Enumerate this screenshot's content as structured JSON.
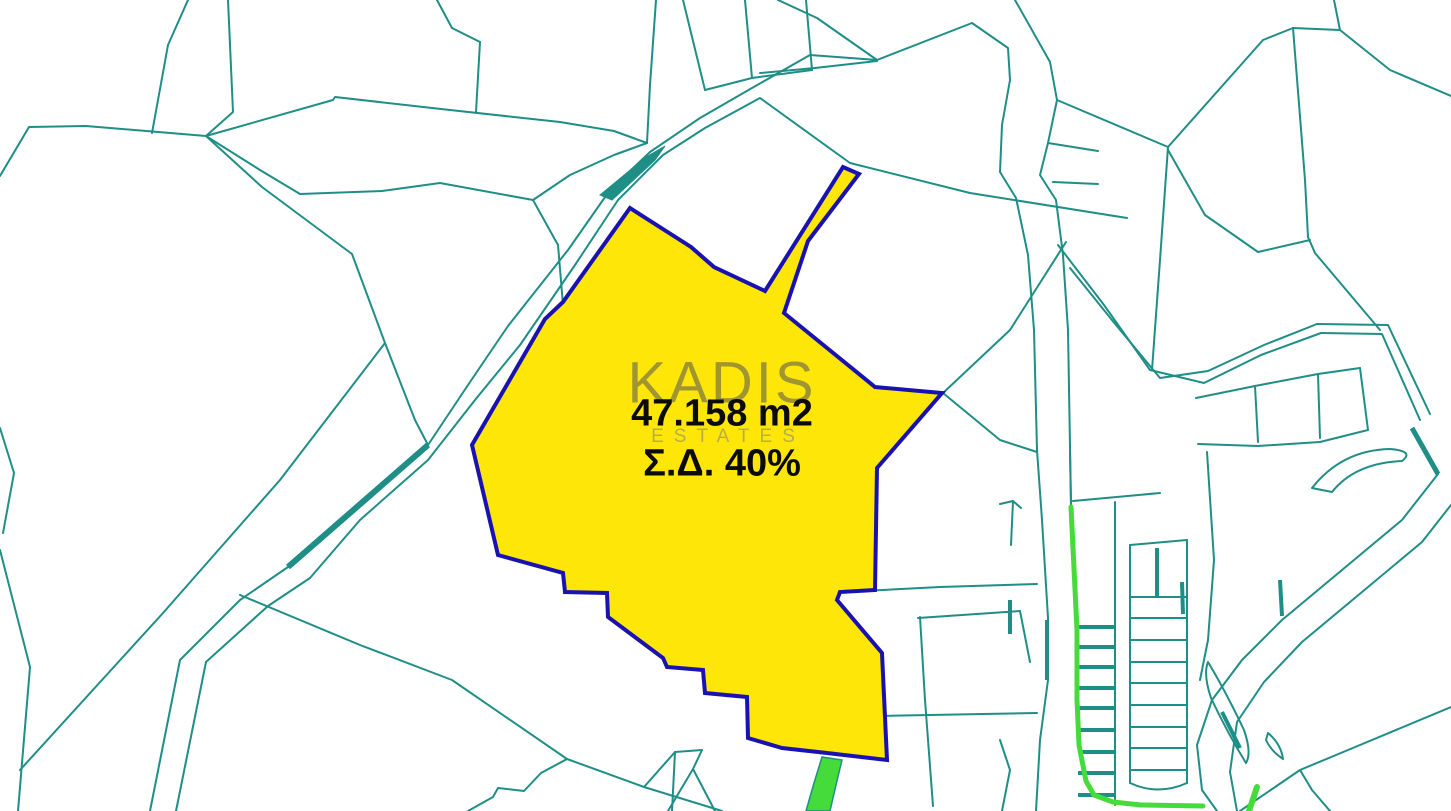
{
  "watermark": {
    "brand": "KADIS",
    "sub": "ESTATES"
  },
  "parcel": {
    "area_label": "47.158 m2",
    "density_label": "Σ.Δ. 40%",
    "points": "630,208 691,247 714,267 765,291 843,167 859,174 808,241 784,313 875,387 942,393 877,468 875,590 840,592 837,600 882,653 887,760 827,753 782,748 748,738 747,697 705,693 703,670 667,667 663,658 608,617 607,593 565,592 563,573 498,555 472,445 545,319 563,302"
  },
  "colors": {
    "line": "#1F8E86",
    "parcel_fill": "#FFE609",
    "parcel_stroke": "#1A12B0",
    "green": "#45DB3B",
    "text": "#0B0B0B",
    "watermark": "#525252"
  },
  "map": {
    "viewbox": "0 0 1451 811",
    "thin_lines": [
      "188,0 168,45 152,133",
      "228,0 233,112 206,136",
      "0,176 29,127 86,126 206,136",
      "206,136 333,100 335,97 450,110 560,122 614,131 647,143",
      "206,136 262,187 352,254 385,343 415,420 428,445",
      "206,136 260,170 300,194 382,191 440,183 533,200",
      "533,200 558,245 563,305",
      "533,200 570,175 614,155 647,143",
      "0,428 14,473 3,533",
      "0,550 30,667 18,811",
      "20,770 163,613 280,480 385,343",
      "150,811 180,660 240,600 288,567",
      "176,811 206,662 268,606 310,578 360,520 428,460 475,400 520,345 575,265 618,200 663,155 705,128 760,98 850,163",
      "428,445 470,382 508,326 568,250 610,190 650,152",
      "650,152 700,118 752,88 810,55 877,60 972,23",
      "778,0 817,18 877,60",
      "760,73 815,68 877,61",
      "850,163 970,193 1127,218",
      "972,23 1008,48 1010,80 1002,125 1000,172 1016,198 1028,255 1034,330 1037,450",
      "1015,0 1050,62 1057,100 1048,143 1040,175 1056,200 1063,255 1068,330 1071,505",
      "1057,100 1168,147 1263,40",
      "1263,40 1293,28",
      "1293,28 1340,30 1334,0",
      "1340,30 1390,70 1451,96",
      "1293,28 1305,180 1308,237",
      "1308,237 1315,253 1380,330",
      "1168,147 1160,260 1152,370",
      "1168,150 1205,215 1258,252",
      "1258,252 1310,240",
      "1058,245 1104,305 1150,370 1204,383 1261,355 1321,333",
      "1070,268 1116,325 1160,378 1208,371 1264,345 1317,324",
      "1321,333 1382,334 1420,420",
      "1317,324 1388,325 1430,414",
      "1438,474 1402,520 1342,570 1282,620 1242,660 1212,700 1197,745 1202,790 1217,811",
      "1451,505 1422,542 1362,592 1302,642 1264,682 1237,722 1230,772 1237,811",
      "1196,398 1255,386 1318,374 1360,368",
      "1255,386 1258,442",
      "1318,374 1320,438",
      "1198,444 1258,446 1320,442",
      "1360,368 1368,430 1320,442",
      "1037,450 1042,520 1048,618 1048,680 1040,740 1036,811",
      "1000,504 1013,501 1021,508",
      "1013,501 1011,545",
      "1071,505 1070,452",
      "1073,501 1160,493",
      "1115,502 1115,805",
      "1130,545 1130,783",
      "1187,540 1187,783",
      "1130,545 1187,540",
      "1130,597 1187,597",
      "1130,618 1187,618",
      "1130,640 1187,640",
      "1130,662 1187,662",
      "1130,683 1187,683",
      "1130,705 1187,705",
      "1130,727 1187,727",
      "1130,748 1187,748",
      "1130,770 1187,770",
      "943,393 1010,330 1066,242",
      "943,393 1000,440 1037,452",
      "843,592 940,587 1037,584",
      "824,717 1037,713",
      "920,617 925,700 933,806",
      "918,618 1020,611",
      "1020,611 1030,662",
      "240,595 360,645 452,680 567,759",
      "567,759 644,787 722,811",
      "567,759 541,773 524,791 498,788 493,797 468,811",
      "644,787 675,752 702,750",
      "675,752 672,811",
      "702,750 693,769 668,811",
      "693,769 715,811",
      "1000,740 1010,770 1002,811",
      "1240,811 1300,770 1360,745 1451,707",
      "1300,770 1312,790 1330,811",
      "683,0 705,90",
      "745,0 752,78",
      "705,90 752,78 812,70",
      "806,0 812,70",
      "656,0 650,85 647,143",
      "437,0 452,28 480,42",
      "480,42 476,112",
      "1048,143 1098,151",
      "1053,182 1098,184",
      "1207,452 1214,560 1208,640 1200,680"
    ],
    "paths": [
      "M1130,783 Q1158,796 1187,783",
      "M1312,488 Q1342,450 1390,449 Q1415,451 1402,461 Q1355,463 1332,492 Z",
      "M1208,662 Q1226,692 1244,730 Q1252,753 1246,763 Q1228,734 1211,698 Q1203,674 1208,662 Z",
      "M1268,733 Q1281,744 1283,759 Q1271,751 1266,740 Z"
    ],
    "thick_lines": [
      {
        "points": "288,567 428,445",
        "w": 6
      },
      {
        "points": "1047,620 1047,680",
        "w": 4
      },
      {
        "points": "1010,600 1010,634",
        "w": 4
      },
      {
        "points": "1157,548 1157,598",
        "w": 4
      },
      {
        "points": "1280,580 1282,616",
        "w": 4
      },
      {
        "points": "1222,712 1240,748",
        "w": 4
      },
      {
        "points": "1412,428 1438,474",
        "w": 5
      },
      {
        "points": "1182,582 1183,614",
        "w": 4
      },
      {
        "points": "1078,627 1115,627",
        "w": 4
      },
      {
        "points": "1078,647 1115,647",
        "w": 4
      },
      {
        "points": "1078,667 1115,667",
        "w": 4
      },
      {
        "points": "1078,688 1115,688",
        "w": 4
      },
      {
        "points": "1078,708 1115,708",
        "w": 4
      },
      {
        "points": "1078,730 1115,730",
        "w": 4
      },
      {
        "points": "1078,752 1115,752",
        "w": 4
      },
      {
        "points": "1078,773 1115,773",
        "w": 4
      },
      {
        "points": "1078,795 1115,795",
        "w": 4
      }
    ],
    "teal_fills": [
      "600,195 646,157 665,146 655,160 612,200"
    ],
    "green_lines": [
      {
        "points": "1071,507 1077,630 1077,700 1079,745 1086,781 1094,795 1113,802 1141,805 1203,806",
        "w": 5
      },
      {
        "points": "1249,811 1257,787",
        "w": 6
      }
    ],
    "green_fills": [
      "822,757 842,760 836,785 830,811 806,811 814,783"
    ]
  }
}
